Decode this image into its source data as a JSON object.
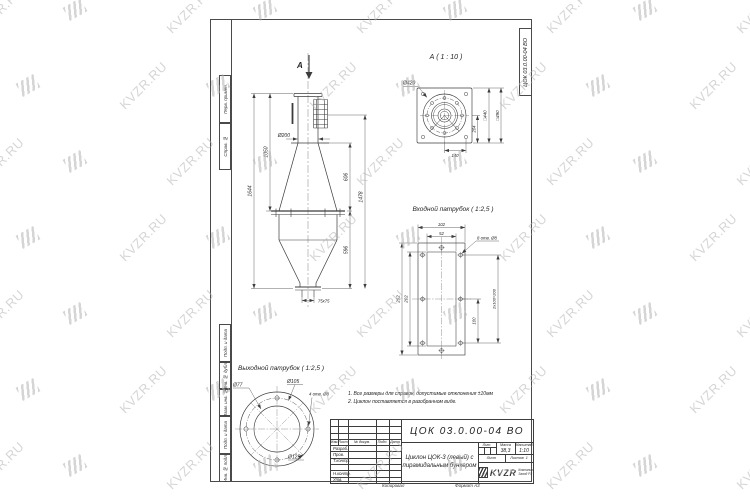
{
  "watermark": {
    "text": "KVZR.RU"
  },
  "sheet": {
    "corner_stamp": "ЦОК 03.0.00-04 ВО",
    "margin_labels": [
      "Перв. примен.",
      "Справ. №",
      "Подп. и дата",
      "Инв. № дубл.",
      "Взам. инв. №",
      "Подп. и дата",
      "Инв. № подл."
    ],
    "footer_copy": "Копировал",
    "footer_format": "Формат А3"
  },
  "main_view": {
    "section_arrow_label": "А",
    "dim_total_height": "1644",
    "dim_upper_height": "1050",
    "dim_pipe_dia": "Ø200",
    "dim_cone_height": "606",
    "dim_right_height": "1478",
    "dim_bunker_height": "596",
    "dim_outlet": "75x75"
  },
  "detail_a": {
    "title": "А ( 1 : 10 )",
    "dim_dia": "Ø420",
    "dim_sq_inner": "□440",
    "dim_sq_outer": "□490",
    "dim_side": "204",
    "dim_bottom": "140"
  },
  "inlet_detail": {
    "title": "Входной патрубок ( 1:2,5 )",
    "dim_width_outer": "102",
    "dim_width_inner": "52",
    "holes_note": "8 отв. Ø8",
    "dim_height_outer": "252",
    "dim_height_inner": "202",
    "dim_pitch_half": "100",
    "dim_pitch": "2x100=200"
  },
  "outlet_detail": {
    "title": "Выходной патрубок ( 1:2,5 )",
    "dim_d1": "Ø77",
    "dim_d2": "Ø105",
    "holes_note": "4 отв. Ø8",
    "dim_d3": "Ø125"
  },
  "notes": {
    "line1": "1. Все размеры для справок, допустимые отклонения ±10мм",
    "line2": "2. Циклон поставляется в разобранном виде."
  },
  "title_block": {
    "designation": "ЦОК 03.0.00-04 ВО",
    "name_line1": "Циклон ЦОК-3 (левый) с",
    "name_line2": "пирамидальным бункером",
    "col_izm": "Изм.",
    "col_list": "Лист",
    "col_doc": "№ докум.",
    "col_podp": "Подп.",
    "col_data": "Дата",
    "rows": [
      "Разраб.",
      "Пров.",
      "Т.контр.",
      "",
      "Н.контр.",
      "Утв."
    ],
    "lit_label": "Лит.",
    "massa_label": "Масса",
    "masshtab_label": "Масштаб",
    "massa_value": "38,3",
    "masshtab_value": "1:10",
    "list_label": "Лист",
    "listov_label": "Листов",
    "listov_value": "1",
    "company_logo": "KVZR",
    "company_line1": "Компания",
    "company_line2": "Завод РЗ"
  }
}
